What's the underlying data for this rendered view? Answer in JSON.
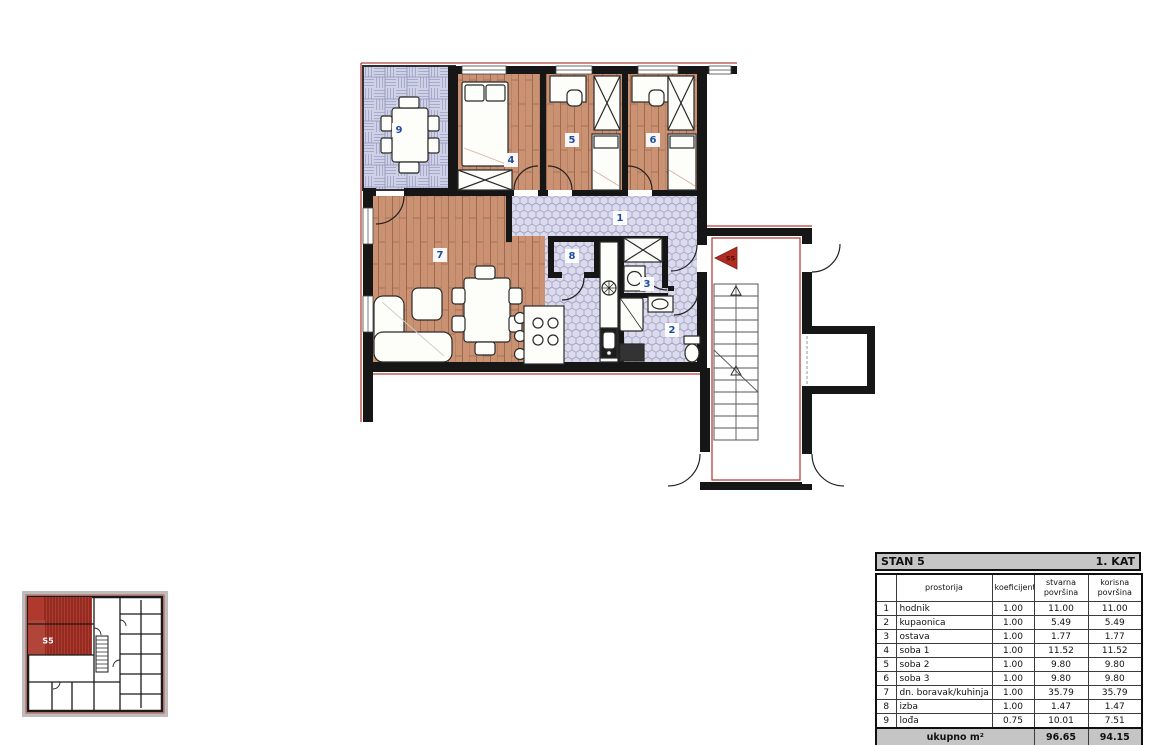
{
  "plan": {
    "room_labels": [
      "1",
      "2",
      "3",
      "4",
      "5",
      "6",
      "7",
      "8",
      "9"
    ],
    "entrance_marker": {
      "label": "S5"
    },
    "mini_overview": {
      "unit_label": "S5"
    },
    "colors": {
      "wall": "#161616",
      "wood_floor": "#cb9173",
      "tile_lavender": "#dcdbee",
      "accent_red": "#b0392e",
      "label_blue": "#1d4f9e",
      "marker_red": "#b02c20",
      "table_header_gray": "#c5c5c5"
    }
  },
  "table": {
    "title_left": "STAN 5",
    "title_right": "1. KAT",
    "headers": {
      "room": "prostorija",
      "coefficient": "koeficijent",
      "actual_area": "stvarna površina",
      "usable_area": "korisna površina"
    },
    "rows": [
      {
        "num": "1",
        "name": "hodnik",
        "koef": "1.00",
        "stvarna": "11.00",
        "korisna": "11.00"
      },
      {
        "num": "2",
        "name": "kupaonica",
        "koef": "1.00",
        "stvarna": "5.49",
        "korisna": "5.49"
      },
      {
        "num": "3",
        "name": "ostava",
        "koef": "1.00",
        "stvarna": "1.77",
        "korisna": "1.77"
      },
      {
        "num": "4",
        "name": "soba 1",
        "koef": "1.00",
        "stvarna": "11.52",
        "korisna": "11.52"
      },
      {
        "num": "5",
        "name": "soba 2",
        "koef": "1.00",
        "stvarna": "9.80",
        "korisna": "9.80"
      },
      {
        "num": "6",
        "name": "soba 3",
        "koef": "1.00",
        "stvarna": "9.80",
        "korisna": "9.80"
      },
      {
        "num": "7",
        "name": "dn. boravak/kuhinja",
        "koef": "1.00",
        "stvarna": "35.79",
        "korisna": "35.79"
      },
      {
        "num": "8",
        "name": "izba",
        "koef": "1.00",
        "stvarna": "1.47",
        "korisna": "1.47"
      },
      {
        "num": "9",
        "name": "lođa",
        "koef": "0.75",
        "stvarna": "10.01",
        "korisna": "7.51"
      }
    ],
    "footer": {
      "label": "ukupno m²",
      "stvarna": "96.65",
      "korisna": "94.15"
    }
  }
}
